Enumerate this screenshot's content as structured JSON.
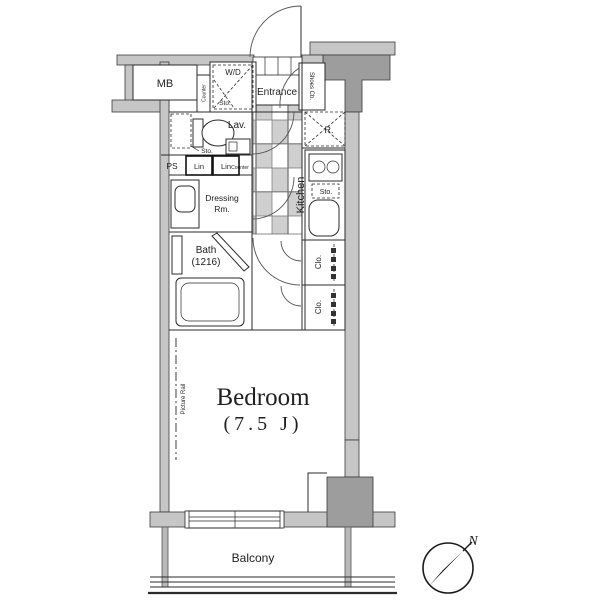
{
  "plan": {
    "type": "apartment-floor-plan",
    "colors": {
      "wall_light": "#c6c6c6",
      "wall_dark": "#9d9d9d",
      "line": "#2b2b2b",
      "tile": "#cfcfcf",
      "background": "#ffffff"
    },
    "rooms": {
      "mb": "MB",
      "wd": "W/D",
      "wd_sto": "Sto.",
      "wd_counter": "Counter",
      "entrance": "Entrance",
      "shoes": "Shoes Cb.",
      "lav": "Lav.",
      "lav_sto": "Sto.",
      "ps": "PS",
      "lin1": "Lin",
      "lin2": "Lin",
      "counter": "Counter",
      "dressing_line1": "Dressing",
      "dressing_line2": "Rm.",
      "bath_line1": "Bath",
      "bath_line2": "(1216)",
      "kitchen": "Kitchen",
      "fridge": "R.",
      "kitchen_sto": "Sto.",
      "clo_top": "Clo.",
      "clo_bottom": "Clo.",
      "bedroom_name": "Bedroom",
      "bedroom_size": "(7.5 J)",
      "picture_rail": "Picture Rail",
      "balcony": "Balcony",
      "compass_n": "N"
    }
  }
}
